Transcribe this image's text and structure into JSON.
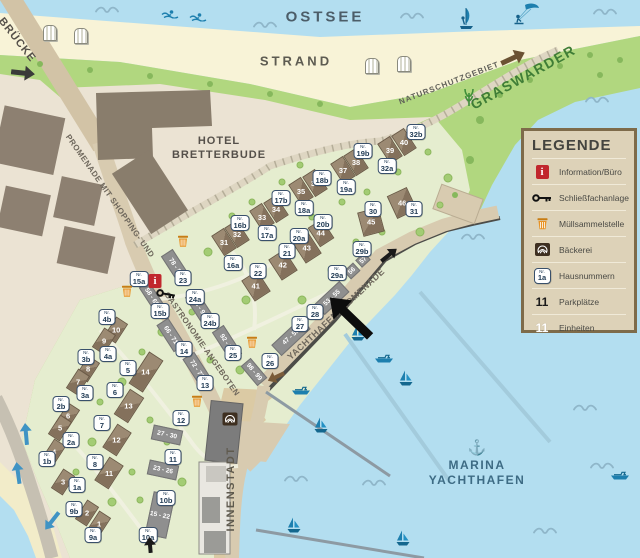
{
  "labels": [
    {
      "t": "OSTSEE",
      "x": 325,
      "y": 17,
      "s": 15,
      "c": "#4c5d68",
      "r": 0,
      "ls": 3
    },
    {
      "t": "STRAND",
      "x": 296,
      "y": 61,
      "s": 13,
      "c": "#5d5b51",
      "r": 0,
      "ls": 3
    },
    {
      "t": "NATURSCHUTZGEBIET",
      "x": 449,
      "y": 83,
      "s": 8,
      "c": "#5f5f58",
      "r": -21,
      "ls": 1
    },
    {
      "t": "GRASWARDER",
      "x": 523,
      "y": 77,
      "s": 14,
      "c": "#3f7d36",
      "r": -29,
      "ls": 1.5
    },
    {
      "t": "HOTEL",
      "x": 219,
      "y": 141,
      "s": 11,
      "c": "#55504a",
      "r": 0,
      "ls": 1
    },
    {
      "t": "BRETTERBUDE",
      "x": 219,
      "y": 155,
      "s": 11,
      "c": "#55504a",
      "r": 0,
      "ls": 1
    },
    {
      "t": "BRÜCKE",
      "x": 17,
      "y": 40,
      "s": 11,
      "c": "#55504a",
      "r": 52,
      "ls": 1
    },
    {
      "t": "PROMENADE MIT SHOPPING- UND",
      "x": 110,
      "y": 196,
      "s": 8,
      "c": "#6e675c",
      "r": 55,
      "ls": 0.5
    },
    {
      "t": "GASTRONOMIE-ANGEBOTEN",
      "x": 202,
      "y": 344,
      "s": 8,
      "c": "#6e675c",
      "r": 55,
      "ls": 0.5
    },
    {
      "t": "YACHTHAFENPROMENADE",
      "x": 336,
      "y": 314,
      "s": 9,
      "c": "#6e675c",
      "r": -43,
      "ls": 0.5
    },
    {
      "t": "INNENSTADT",
      "x": 231,
      "y": 489,
      "s": 11,
      "c": "#5f5a4e",
      "r": -90,
      "ls": 1.5
    },
    {
      "t": "MARINA",
      "x": 477,
      "y": 465,
      "s": 12,
      "c": "#3d6b84",
      "r": 0,
      "ls": 1.5
    },
    {
      "t": "YACHTHAFEN",
      "x": 477,
      "y": 480,
      "s": 12,
      "c": "#3d6b84",
      "r": 0,
      "ls": 1.5
    }
  ],
  "legend": {
    "title": "LEGENDE",
    "items": [
      {
        "icon": "info",
        "label": "Information/Büro"
      },
      {
        "icon": "key",
        "label": "Schließfachanlage"
      },
      {
        "icon": "trash",
        "label": "Müllsammelstelle"
      },
      {
        "icon": "pretzel",
        "label": "Bäckerei"
      },
      {
        "icon": "badge",
        "badge": "1a",
        "label": "Hausnummern"
      },
      {
        "icon": "black-number",
        "sample": "11",
        "label": "Parkplätze"
      },
      {
        "icon": "white-number",
        "sample": "11",
        "label": "Einheiten"
      }
    ]
  },
  "houses": [
    [
      "31",
      224,
      242,
      15,
      24,
      -33
    ],
    [
      "32",
      237,
      234,
      15,
      24,
      -33
    ],
    [
      "33",
      262,
      217,
      15,
      24,
      -33
    ],
    [
      "34",
      276,
      209,
      15,
      24,
      -33
    ],
    [
      "35",
      301,
      191,
      15,
      24,
      -33
    ],
    [
      "36",
      315,
      183,
      15,
      24,
      -33
    ],
    [
      "37",
      343,
      170,
      15,
      24,
      -33
    ],
    [
      "38",
      356,
      162,
      15,
      24,
      -33
    ],
    [
      "39",
      390,
      150,
      15,
      24,
      -33
    ],
    [
      "40",
      404,
      142,
      15,
      24,
      -33
    ],
    [
      "41",
      256,
      286,
      19,
      25,
      -33
    ],
    [
      "42",
      283,
      265,
      19,
      25,
      -33
    ],
    [
      "43",
      307,
      248,
      19,
      25,
      -33
    ],
    [
      "44",
      321,
      233,
      17,
      23,
      -33
    ],
    [
      "45",
      371,
      222,
      22,
      25,
      -15
    ],
    [
      "46",
      402,
      203,
      22,
      25,
      -25
    ],
    [
      "10",
      116,
      330,
      14,
      23,
      33
    ],
    [
      "9",
      104,
      341,
      14,
      23,
      33
    ],
    [
      "8",
      88,
      369,
      14,
      23,
      33
    ],
    [
      "7",
      78,
      382,
      14,
      23,
      33
    ],
    [
      "6",
      68,
      416,
      14,
      23,
      33
    ],
    [
      "5",
      60,
      428,
      14,
      23,
      33
    ],
    [
      "4",
      54,
      452,
      14,
      23,
      33
    ],
    [
      "3",
      63,
      482,
      14,
      23,
      33
    ],
    [
      "2",
      87,
      513,
      14,
      23,
      33
    ],
    [
      "1",
      99,
      524,
      14,
      23,
      33
    ],
    [
      "14",
      146,
      372,
      17,
      38,
      33
    ],
    [
      "13",
      129,
      406,
      17,
      30,
      33
    ],
    [
      "12",
      117,
      440,
      17,
      28,
      33
    ],
    [
      "11",
      109,
      473,
      17,
      28,
      33
    ]
  ],
  "unit_buildings": [
    [
      "78 - 81",
      176,
      267,
      34,
      14,
      57
    ],
    [
      "58 - 65",
      152,
      297,
      30,
      12,
      57
    ],
    [
      "84 - 91",
      200,
      308,
      34,
      14,
      57
    ],
    [
      "66 - 71",
      171,
      335,
      32,
      14,
      57
    ],
    [
      "92 - 97",
      227,
      343,
      34,
      14,
      57
    ],
    [
      "72 - 77",
      197,
      369,
      32,
      14,
      57
    ],
    [
      "98 - 99",
      254,
      372,
      26,
      13,
      50
    ],
    [
      "47 - 52",
      291,
      337,
      40,
      15,
      -43
    ],
    [
      "53 - 55",
      332,
      298,
      34,
      15,
      -43
    ],
    [
      "56",
      352,
      271,
      13,
      11,
      -43
    ],
    [
      "57",
      363,
      260,
      12,
      10,
      -43
    ],
    [
      "27 - 30",
      167,
      435,
      30,
      15,
      12
    ],
    [
      "23 - 26",
      163,
      470,
      30,
      15,
      12
    ],
    [
      "15 - 22",
      160,
      515,
      22,
      44,
      12
    ]
  ],
  "house_badges": [
    [
      "16b",
      240,
      223
    ],
    [
      "17b",
      281,
      198
    ],
    [
      "18b",
      322,
      178
    ],
    [
      "19b",
      363,
      151
    ],
    [
      "32b",
      416,
      132
    ],
    [
      "16a",
      233,
      263
    ],
    [
      "17a",
      267,
      233
    ],
    [
      "18a",
      304,
      208
    ],
    [
      "19a",
      346,
      187
    ],
    [
      "32a",
      387,
      166
    ],
    [
      "20b",
      323,
      222
    ],
    [
      "20a",
      299,
      236
    ],
    [
      "21",
      287,
      251
    ],
    [
      "22",
      258,
      271
    ],
    [
      "30",
      373,
      209
    ],
    [
      "31",
      414,
      209
    ],
    [
      "29b",
      362,
      249
    ],
    [
      "29a",
      337,
      273
    ],
    [
      "28",
      315,
      312
    ],
    [
      "27",
      300,
      324
    ],
    [
      "26",
      270,
      361
    ],
    [
      "25",
      233,
      353
    ],
    [
      "24a",
      195,
      297
    ],
    [
      "24b",
      210,
      321
    ],
    [
      "23",
      183,
      278
    ],
    [
      "15a",
      139,
      279
    ],
    [
      "15b",
      160,
      311
    ],
    [
      "14",
      184,
      349
    ],
    [
      "13",
      205,
      383
    ],
    [
      "12",
      181,
      418
    ],
    [
      "11",
      173,
      457
    ],
    [
      "10b",
      166,
      498
    ],
    [
      "10a",
      148,
      535
    ],
    [
      "9b",
      74,
      509
    ],
    [
      "9a",
      93,
      535
    ],
    [
      "8",
      95,
      462
    ],
    [
      "7",
      102,
      423
    ],
    [
      "6",
      115,
      390
    ],
    [
      "5",
      128,
      368
    ],
    [
      "4b",
      107,
      317
    ],
    [
      "4a",
      108,
      354
    ],
    [
      "3b",
      86,
      357
    ],
    [
      "3a",
      85,
      393
    ],
    [
      "2b",
      61,
      404
    ],
    [
      "2a",
      71,
      440
    ],
    [
      "1b",
      47,
      459
    ],
    [
      "1a",
      77,
      485
    ]
  ],
  "icons": [
    {
      "t": "info",
      "x": 155,
      "y": 281
    },
    {
      "t": "key",
      "x": 166,
      "y": 294,
      "r": 10
    },
    {
      "t": "trash",
      "x": 127,
      "y": 291
    },
    {
      "t": "trash",
      "x": 183,
      "y": 241
    },
    {
      "t": "trash",
      "x": 252,
      "y": 342
    },
    {
      "t": "trash",
      "x": 197,
      "y": 401
    },
    {
      "t": "pretzel",
      "x": 230,
      "y": 419
    },
    {
      "t": "anchor",
      "x": 477,
      "y": 448
    },
    {
      "t": "grass",
      "x": 469,
      "y": 97
    },
    {
      "t": "chair",
      "x": 50,
      "y": 33
    },
    {
      "t": "chair",
      "x": 81,
      "y": 36
    },
    {
      "t": "chair",
      "x": 372,
      "y": 66
    },
    {
      "t": "chair",
      "x": 404,
      "y": 64
    },
    {
      "t": "swimmer",
      "x": 170,
      "y": 14
    },
    {
      "t": "swimmer",
      "x": 198,
      "y": 17
    },
    {
      "t": "windsurf",
      "x": 466,
      "y": 18
    },
    {
      "t": "kitesurf",
      "x": 526,
      "y": 14
    },
    {
      "t": "wave",
      "x": 107,
      "y": 10
    },
    {
      "t": "wave",
      "x": 265,
      "y": 25
    },
    {
      "t": "wave",
      "x": 412,
      "y": 16
    },
    {
      "t": "wave",
      "x": 605,
      "y": 12
    },
    {
      "t": "wave",
      "x": 597,
      "y": 100
    },
    {
      "t": "wave",
      "x": 473,
      "y": 237
    },
    {
      "t": "wave",
      "x": 585,
      "y": 408
    },
    {
      "t": "wave",
      "x": 602,
      "y": 466
    },
    {
      "t": "wave",
      "x": 545,
      "y": 531
    },
    {
      "t": "wave",
      "x": 374,
      "y": 483
    },
    {
      "t": "wave",
      "x": 296,
      "y": 479
    },
    {
      "t": "sailboat",
      "x": 358,
      "y": 333
    },
    {
      "t": "sailboat",
      "x": 406,
      "y": 378
    },
    {
      "t": "sailboat",
      "x": 321,
      "y": 425
    },
    {
      "t": "sailboat",
      "x": 294,
      "y": 525
    },
    {
      "t": "sailboat",
      "x": 403,
      "y": 538
    },
    {
      "t": "motorboat",
      "x": 384,
      "y": 359
    },
    {
      "t": "motorboat",
      "x": 301,
      "y": 391
    },
    {
      "t": "motorboat",
      "x": 620,
      "y": 476
    }
  ],
  "arrows": [
    {
      "n": "location-pointer",
      "x": 350,
      "y": 317,
      "r": -136,
      "l": 56,
      "w": 9,
      "c": "#0d0d0d"
    },
    {
      "n": "bridge-road",
      "x": 23,
      "y": 73,
      "r": 6,
      "l": 24,
      "w": 5,
      "c": "#3a3a3a"
    },
    {
      "n": "quay-road",
      "x": 389,
      "y": 255,
      "r": -39,
      "l": 20,
      "w": 4,
      "c": "#1a1a1a"
    },
    {
      "n": "graswarder-path",
      "x": 513,
      "y": 58,
      "r": -25,
      "l": 26,
      "w": 5,
      "c": "#6b5233"
    },
    {
      "n": "harbor",
      "x": 276,
      "y": 377,
      "r": 155,
      "l": 18,
      "w": 4,
      "c": "#7a5c3a"
    },
    {
      "n": "coast-road-1",
      "x": 26,
      "y": 434,
      "r": -95,
      "l": 22,
      "w": 4,
      "c": "#3f93c4"
    },
    {
      "n": "coast-road-2",
      "x": 18,
      "y": 473,
      "r": -98,
      "l": 22,
      "w": 4,
      "c": "#3f93c4"
    },
    {
      "n": "coast-road-3",
      "x": 52,
      "y": 521,
      "r": 128,
      "l": 22,
      "w": 4,
      "c": "#3f93c4"
    },
    {
      "n": "innenstadt-road",
      "x": 150,
      "y": 545,
      "r": -95,
      "l": 16,
      "w": 4,
      "c": "#1a1a1a"
    }
  ],
  "colors": {
    "water": "#b3def0",
    "sand": "#f8f3d7",
    "green": "#b1d77f",
    "estate": "#e5edcf",
    "city": "#ebe3d3",
    "road": "#d8cbb0",
    "quay": "#4c4c48",
    "info_red": "#c1272d",
    "trash_orange": "#e89325",
    "boat_blue": "#1d7fae",
    "legend_bg": "#ddd2b8",
    "legend_border": "#7e6b4a"
  }
}
